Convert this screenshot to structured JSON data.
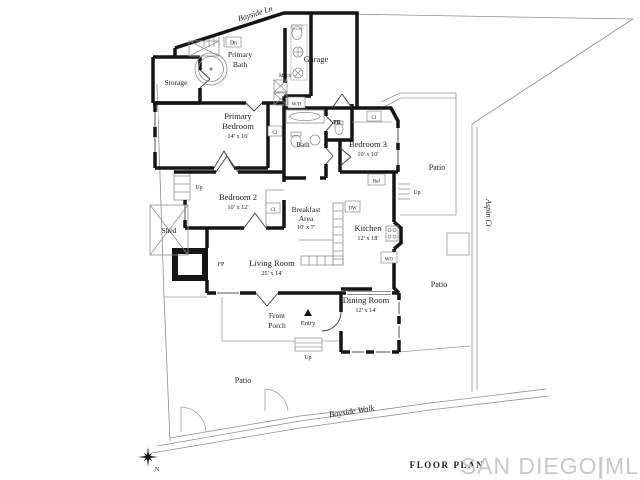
{
  "streets": {
    "top_label": "Bayside Ln",
    "bottom_label": "Bayside Walk",
    "right_label": "Aspin Ct"
  },
  "compass": {
    "north": "N"
  },
  "footer": {
    "caption": "FLOOR PLAN",
    "brand_part1": "SAN DIEGO",
    "brand_divider": "|",
    "brand_part2": "MLS"
  },
  "rooms": {
    "storage": {
      "name": "Storage"
    },
    "primary_bath": {
      "name_line1": "Primary",
      "name_line2": "Bath"
    },
    "garage": {
      "name": "Garage"
    },
    "primary_bedroom": {
      "name_line1": "Primary",
      "name_line2": "Bedroom",
      "dims": "14' x 16'"
    },
    "bath": {
      "name": "Bath"
    },
    "powder_room": {
      "abbr": "PR"
    },
    "bedroom3": {
      "name": "Bedroom 3",
      "dims": "10' x 10'"
    },
    "bedroom2": {
      "name": "Bedroom 2",
      "dims": "10' x 12'"
    },
    "breakfast_area": {
      "name_line1": "Breakfast",
      "name_line2": "Area",
      "dims": "10' x 7'"
    },
    "kitchen": {
      "name": "Kitchen",
      "dims": "12' x 18'"
    },
    "living_room": {
      "name": "Living Room",
      "dims": "25' x 14'"
    },
    "dining_room": {
      "name": "Dining Room",
      "dims": "12' x 14'"
    },
    "front_porch": {
      "name_line1": "Front",
      "name_line2": "Porch"
    },
    "entry": {
      "name": "Entry"
    },
    "shed": {
      "name": "Shed"
    },
    "patio_northeast": {
      "name": "Patio"
    },
    "patio_east": {
      "name": "Patio"
    },
    "patio_southwest": {
      "name": "Patio"
    }
  },
  "annotations": {
    "down": "Dn",
    "up": "Up",
    "closet": "Cl",
    "refrigerator": "Ref",
    "dishwasher": "DW",
    "wall_oven": "WO",
    "fireplace": "FP",
    "mechanical": "Mech",
    "washer_dryer": "W/D"
  },
  "colors": {
    "walls": "#151515",
    "thin_lines": "#8f8f8f",
    "text": "#1c1c1c",
    "brand_gray": "#c9c9c9",
    "background": "#ffffff"
  }
}
